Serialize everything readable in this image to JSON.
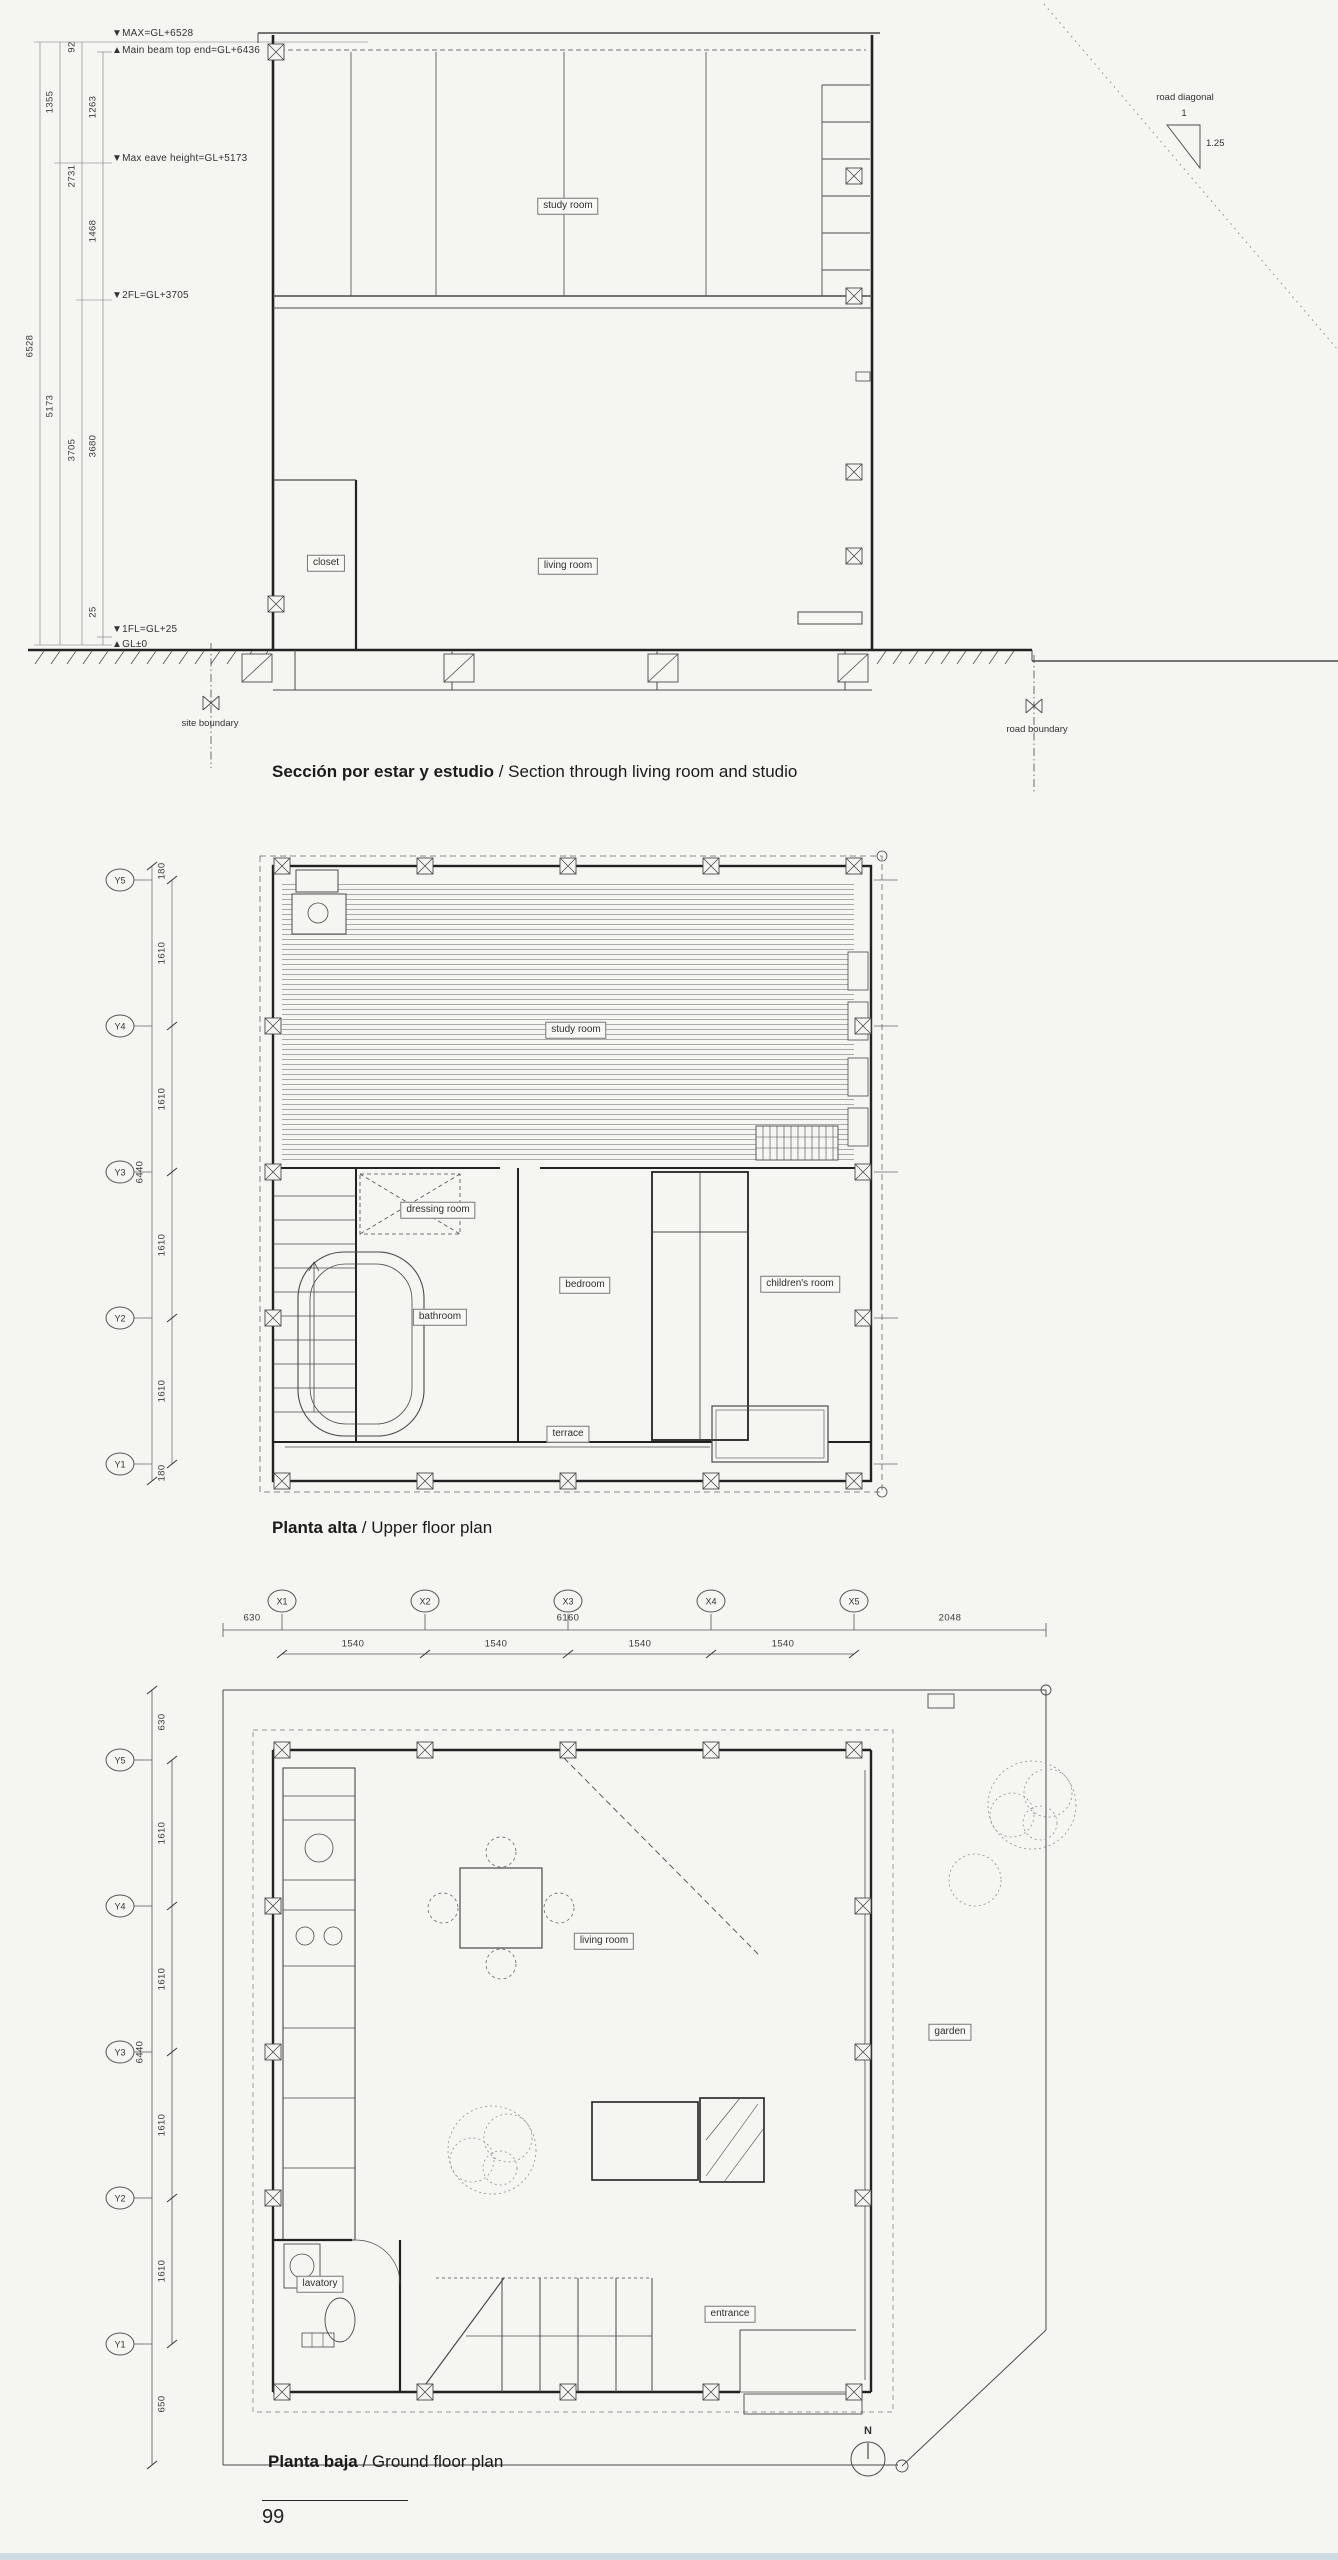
{
  "page_number": "99",
  "section": {
    "title_bold": "Sección por estar y estudio",
    "title_rest": " / Section through living room and studio",
    "ann_max": "▼MAX=GL+6528",
    "ann_beam": "▲Main beam top end=GL+6436",
    "ann_eave": "▼Max eave height=GL+5173",
    "ann_2f": "▼2FL=GL+3705",
    "ann_1f": "▼1FL=GL+25",
    "ann_gl": "▲GL±0",
    "dim_total": "6528",
    "dim_1355": "1355",
    "dim_5173": "5173",
    "dim_92": "92",
    "dim_2731": "2731",
    "dim_3705": "3705",
    "dim_1263": "1263",
    "dim_1468": "1468",
    "dim_3680": "3680",
    "dim_25": "25",
    "room_study": "study room",
    "room_closet": "closet",
    "room_living": "living room",
    "site_boundary": "site boundary",
    "road_boundary": "road boundary",
    "road_diagonal_label": "road diagonal",
    "road_diagonal_rise": "1",
    "road_diagonal_run": "1.25"
  },
  "upper_plan": {
    "title_bold": "Planta alta",
    "title_rest": " / Upper floor plan",
    "axes_y": [
      "Y5",
      "Y4",
      "Y3",
      "Y2",
      "Y1"
    ],
    "dim_margin_top": "180",
    "dim_bay": "1610",
    "dim_total": "6440",
    "dim_margin_bottom": "180",
    "room_study": "study room",
    "room_dressing": "dressing room",
    "room_bathroom": "bathroom",
    "room_bedroom": "bedroom",
    "room_children": "children's room",
    "room_terrace": "terrace"
  },
  "ground_plan": {
    "title_bold": "Planta baja",
    "title_rest": " / Ground floor plan",
    "axes_x": [
      "X1",
      "X2",
      "X3",
      "X4",
      "X5"
    ],
    "dim_left_offset": "630",
    "dim_x_total": "6160",
    "dim_right_offset": "2048",
    "dim_x_bay": "1540",
    "axes_y": [
      "Y5",
      "Y4",
      "Y3",
      "Y2",
      "Y1"
    ],
    "dim_top_offset": "630",
    "dim_y_bay": "1610",
    "dim_y_total": "6440",
    "dim_bottom_offset": "650",
    "room_living": "living room",
    "room_garden": "garden",
    "room_lavatory": "lavatory",
    "room_entrance": "entrance",
    "north": "N"
  }
}
